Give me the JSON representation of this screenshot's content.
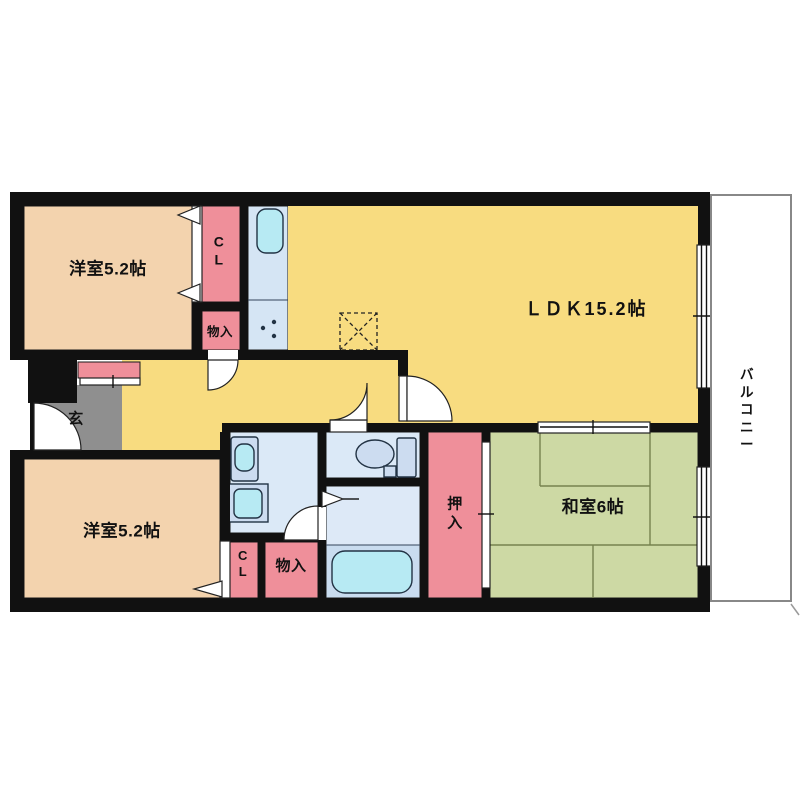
{
  "title": "apartment-floor-plan",
  "labels": {
    "bedroom_top": "洋室5.2帖",
    "ldk": "ＬＤＫ15.2帖",
    "bedroom_bottom": "洋室5.2帖",
    "washitsu": "和室6帖",
    "oshiire": "押\n入",
    "cl_top": "C\nL",
    "cl_bottom": "C\nL",
    "monoire_top": "物入",
    "monoire_bottom": "物入",
    "genkan": "玄",
    "balcony": "バ\nル\nコ\nニ\nー"
  },
  "colors": {
    "c-wall": "#111111",
    "c-bedroom": "#f3d3ae",
    "c-pink": "#ef8f9a",
    "c-yellow": "#f8dc80",
    "c-blue": "#dbe9f7",
    "c-kitchen": "#d5e5f4",
    "c-bathfloor": "#dde9f7",
    "c-bathlower": "#c9dcef",
    "c-cyan": "#b7eaf3",
    "c-fixture": "#ccdcf0",
    "c-green": "#cdd9a4",
    "c-tatami": "#76824e",
    "c-gray": "#8f8f8f",
    "c-balcony": "#888888",
    "c-outline": "#1a1a1a"
  }
}
